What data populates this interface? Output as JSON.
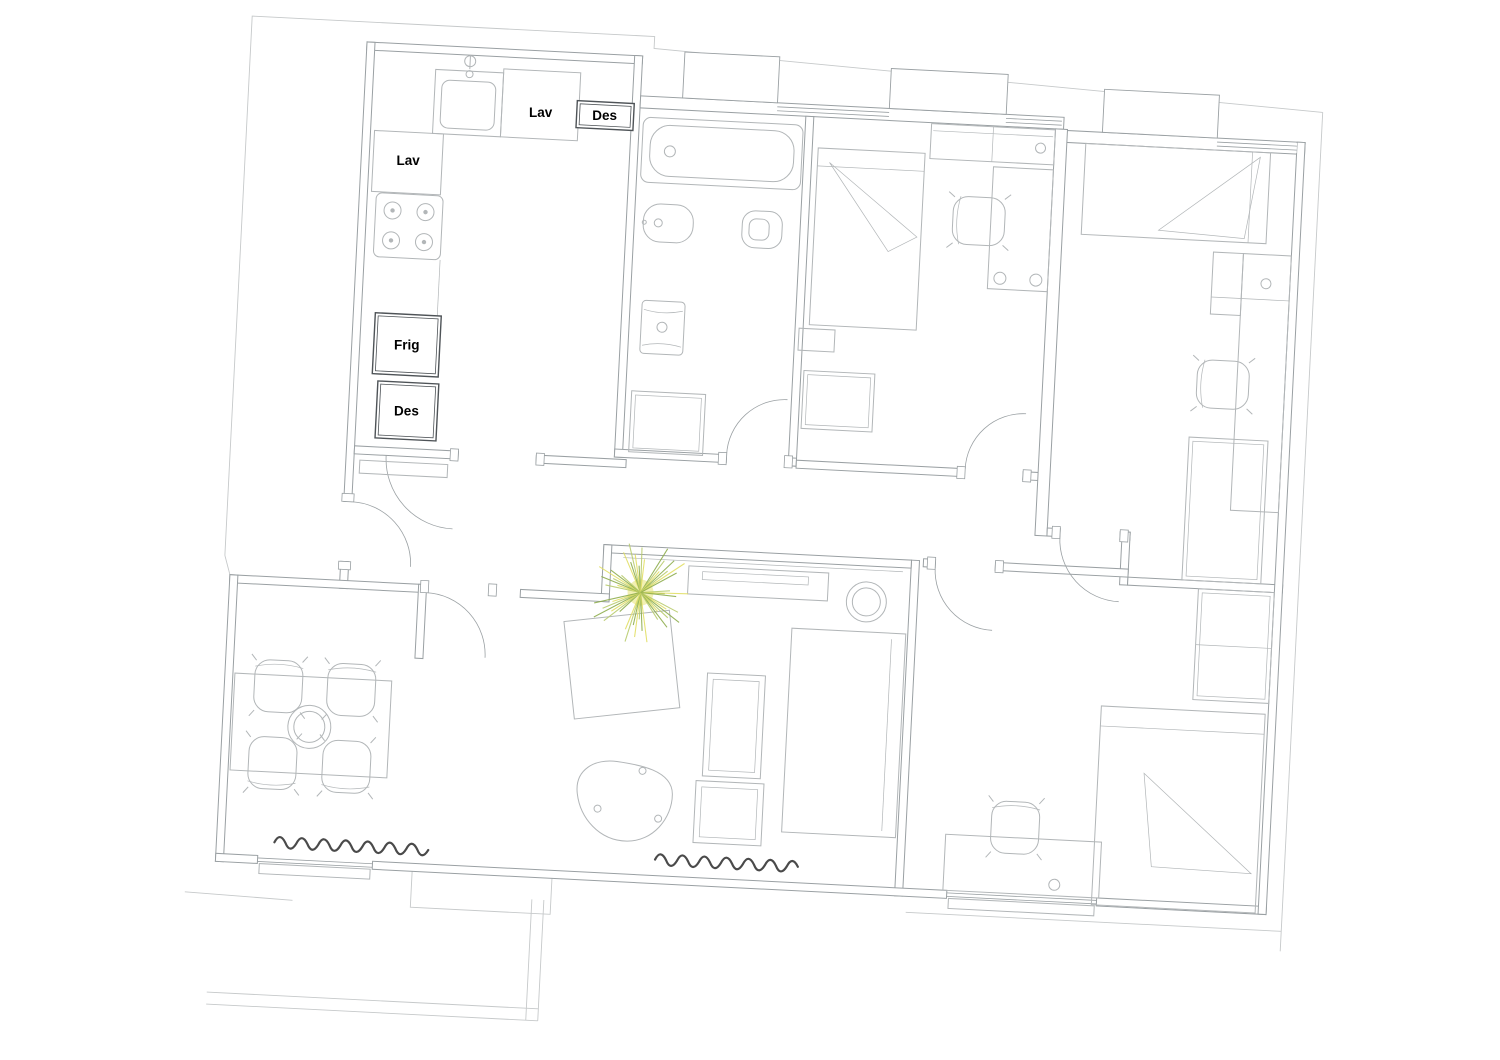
{
  "title": "Apartment floor plan drawing",
  "labels": {
    "kitchen_washer_top": "Lav",
    "kitchen_dishwasher_top": "Des",
    "kitchen_washer_left": "Lav",
    "kitchen_fridge": "Frig",
    "kitchen_pantry": "Des"
  },
  "colors": {
    "background": "#ffffff",
    "wall_line": "#9aa0a3",
    "furniture_line": "#b2b6b8",
    "boundary_line": "#c6c9ca",
    "appliance_line": "#4e5357",
    "label_text": "#000000",
    "curtain": "#4a4a4a",
    "plant_dark": "#8fae4e",
    "plant_mid": "#b9cc6e",
    "plant_light": "#e2df66",
    "plant_core": "#f0eda6"
  },
  "plant": {
    "rays": 46,
    "radius": 54
  },
  "furniture_icons": [
    "kitchen-sink-icon",
    "stove-icon",
    "fridge-icon",
    "bathtub-icon",
    "bidet-icon",
    "toilet-icon",
    "washbasin-icon",
    "bathroom-cabinet-icon",
    "bed-icon",
    "desk-icon",
    "desk-chair-icon",
    "wardrobe-icon",
    "shelf-icon",
    "nightstand-icon",
    "dining-table-icon",
    "dining-chair-icon",
    "sofa-icon",
    "coffee-table-icon",
    "organic-side-table-icon",
    "round-stool-icon",
    "sideboard-icon",
    "plant-icon",
    "curtain-icon",
    "door-swing-icon",
    "window-icon"
  ]
}
